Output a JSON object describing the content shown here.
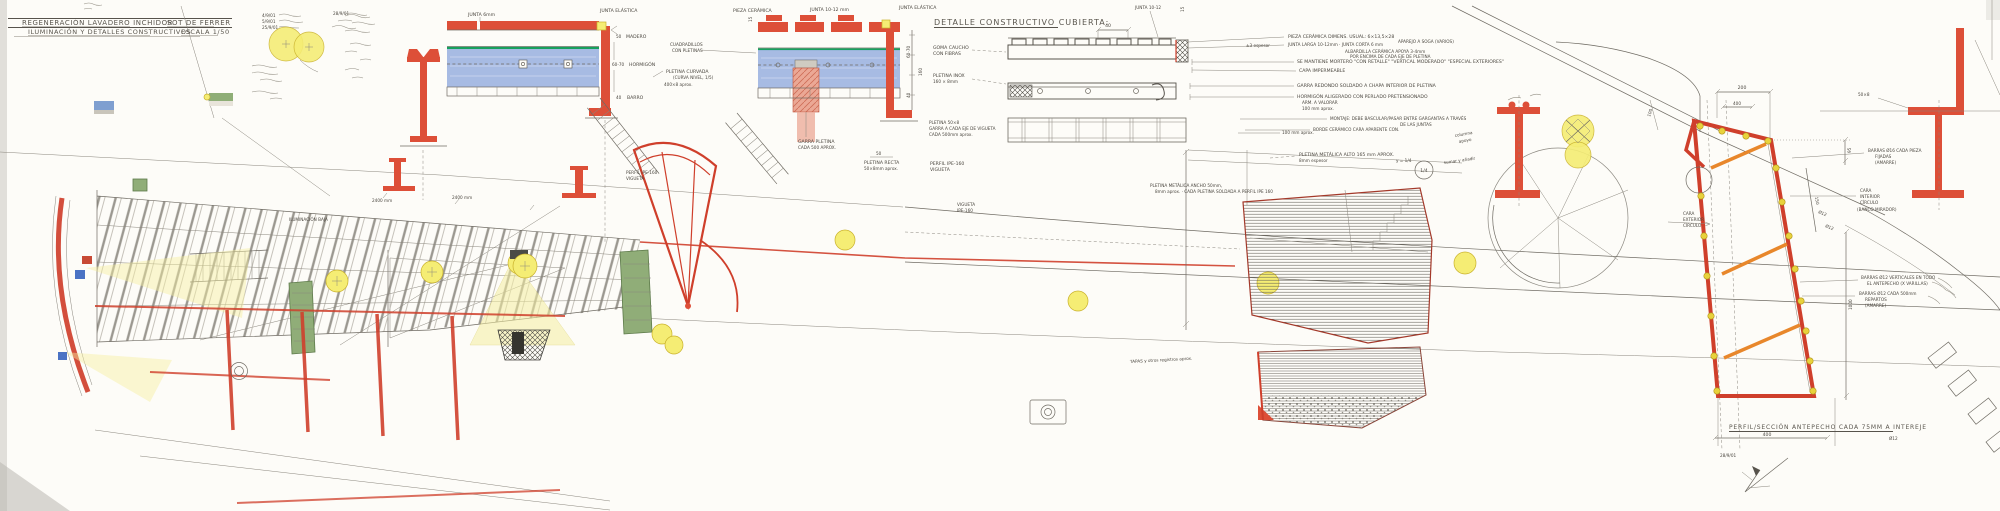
{
  "colors": {
    "red": "#dd4f38",
    "water_blue": "#9db4e0",
    "water_line_green": "#17a05e",
    "luminaire_yellow": "#f5ed74",
    "strut_orange": "#e8872b",
    "pencil": "#6f6b63"
  },
  "title_block": {
    "project": "REGENERACIÓN LAVADERO INCHIDOR",
    "location": "SOT DE FERRER",
    "subtitle": "ILUMINACIÓN Y DETALLES CONSTRUCTIVOS",
    "scale_label": "ESCALA 1/50"
  },
  "revisions": {
    "r1": "4/9/01",
    "r2": "5/9/01",
    "r3": "25/9/01",
    "r4": "28/9/01"
  },
  "common": {
    "junta_elastica": "JUNTA ELÁSTICA"
  },
  "pool": {
    "junta6": "JUNTA 6mm",
    "pieza_ceramica": "PIEZA CERÁMICA",
    "junta_1012": "JUNTA 10-12 mm",
    "dim15": "15",
    "madero_dim": "50",
    "madero": "MADERO",
    "hormigon_dim": "60-70",
    "hormigon": "HORMIGÓN",
    "barro_dim": "40",
    "barro": "BARRO",
    "cuadradillos_1": "CUADRADILLOS",
    "cuadradillos_2": "CON PLETINAS",
    "pletina_curvada_1": "PLETINA CURVADA",
    "pletina_curvada_2": "(CURVA NIVEL, 1/5)",
    "pletina_curvada_3": "400×8 aprox.",
    "garra_1": "GARRA PLETINA",
    "garra_2": "CADA 500 APROX.",
    "pletina_recta_dim": "50",
    "pletina_recta_1": "PLETINA RECTA",
    "pletina_recta_2": "50×8mm aprox."
  },
  "cubierta": {
    "title": "DETALLE CONSTRUCTIVO CUBIERTA:",
    "goma_1": "GOMA CAUCHO",
    "goma_2": "CON FIBRAS",
    "pletina_inox_1": "PLETINA INOX",
    "pletina_inox_2": "160 × 8mm",
    "dim_6070": "60-70",
    "dim_160": "160",
    "dim_40b": "40",
    "dim_40": "40",
    "junta_top": "JUNTA 10-12",
    "dim_15": "15",
    "ann1a": "PIEZA CERÁMICA DIMENS. USUAL: 6×13,5×28",
    "ann1b": "JUNTA LARGA 10-12mm · JUNTA CORTA 6 mm",
    "ann1c": "APAREJO A SOGA (VARIOS)",
    "ann1d_1": "ALBARDILLA CERÁMICA APOYA 3-4mm",
    "ann1d_2": "POR ENCIMA DE CADA EJE DE PLETINA",
    "ann_esp": "±3 espesor",
    "ann2": "SE MANTIENE MORTERO \"CON RETALLE\" \"VERTICAL MODERADO\" \"ESPECIAL EXTERIORES\"",
    "ann3": "CAPA IMPERMEABLE",
    "ann4": "GARRA REDONDO SOLDADO A CHAPA INTERIOR DE PLETINA",
    "ann5a": "HORMIGÓN ALIGERADO CON PERLADO PRETENSIONADO",
    "ann5b": "ARM. A VALORAR",
    "ann5c": "100 mm aprox.",
    "ann6_1": "MONTAJE: DEBE BASCULAR/PASAR ENTRE GARGANTAS A TRAVÉS",
    "ann6_2": "DE LAS JUNTAS",
    "ann7": "BORDE CERÁMICO CARA APARENTE CON."
  },
  "plan": {
    "perfil_ipe_1": "PERFIL IPE-160",
    "perfil_ipe_2": "VIGUETA",
    "vigueta_1": "VIGUETA",
    "vigueta_2": "IPE-160",
    "pletina_5008_1": "PLETINA 50×8",
    "pletina_5008_2": "GARRA A CADA EJE DE VIGUETA",
    "pletina_5008_3": "CADA 500mm aprox.",
    "dim_2400": "2400 mm",
    "ilum_baja": "ILUMINACIÓN BAJA",
    "dim100": "100 mm aprox.",
    "pletina_alto_1": "PLETINA METÁLICA  ALTO 165 mm APROX.",
    "pletina_alto_2": "8mm espesor",
    "pletina_ancho_1": "PLETINA METÁLICA ANCHO 50mm,",
    "pletina_ancho_2": "8mm aprox. · CADA PLETINA SOLDADA A PERFIL IPE 160",
    "frac_note": "y = 1/4",
    "frac_circle": "1/4",
    "frac_note2": "sumar y añadir",
    "tapas_note": "TAPAS y otros registros aprox.",
    "columna_1": "columna",
    "columna_2": "apoyo"
  },
  "antepecho": {
    "title": "PERFIL/SECCIÓN ANTEPECHO CADA 75MM A INTEREJE",
    "dia12": "Ø12",
    "dim_400b": "400",
    "date": "28/9/01",
    "dim_200": "200",
    "dim_400": "400",
    "dim_100": "100",
    "dim_95": "95",
    "dim_150": "150",
    "dia12a": "Ø12",
    "dia12b": "Ø12",
    "dim_1000": "1000",
    "barras16_1": "BARRAS Ø16 CADA PIEZA",
    "barras16_2": "FIJADAS",
    "barras16_3": "(AMARRE)",
    "cara_int_1": "CARA",
    "cara_int_2": "INTERIOR",
    "cara_int_3": "CÍRCULO",
    "cara_int_4": "(BANCO MIRADOR)",
    "cara_ext_1": "CARA",
    "cara_ext_2": "EXTERIOR",
    "cara_ext_3": "CÍRCULO",
    "barras12v_1": "BARRAS Ø12 VERTICALES EN TODO",
    "barras12v_2": "EL ANTEPECHO (X VARILLAS)",
    "barras12r_1": "BARRAS Ø12 CADA 500mm",
    "barras12r_2": "REPARTOS",
    "barras12r_3": "(AMARRE)",
    "profile_note": "50×8"
  }
}
